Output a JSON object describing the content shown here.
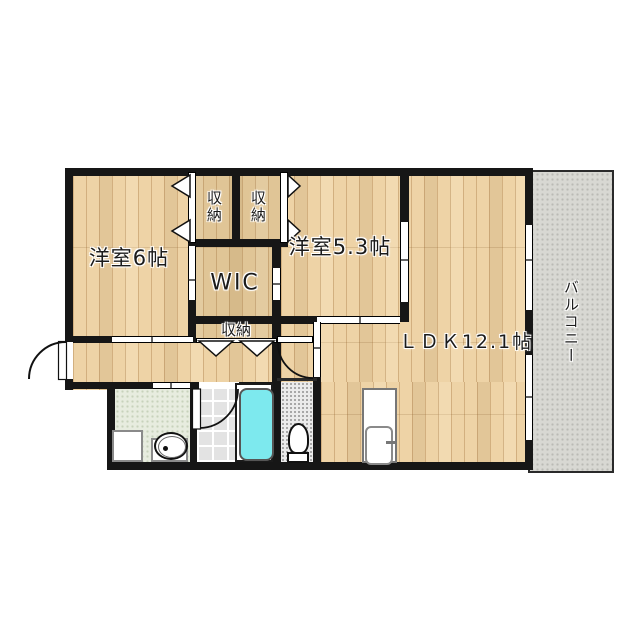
{
  "floorplan": {
    "title": "2LDK apartment floor plan",
    "labels": {
      "bedroom6": "洋室6帖",
      "bedroom53": "洋室5.3帖",
      "wic": "WIC",
      "ldk": "ＬＤＫ12.1帖",
      "closet_top_left": "収納",
      "closet_top_right": "収納",
      "closet_hall": "収納",
      "balcony": "バルコニー"
    },
    "colors": {
      "wall": "#161616",
      "wood_floor": "#eed3a6",
      "balcony_floor": "#d8d8d3",
      "washroom_floor": "#e7ecdf",
      "bathroom_floor": "#e3e3e3",
      "toilet_floor": "#ebebeb",
      "bathtub": "#7de9ee"
    }
  }
}
